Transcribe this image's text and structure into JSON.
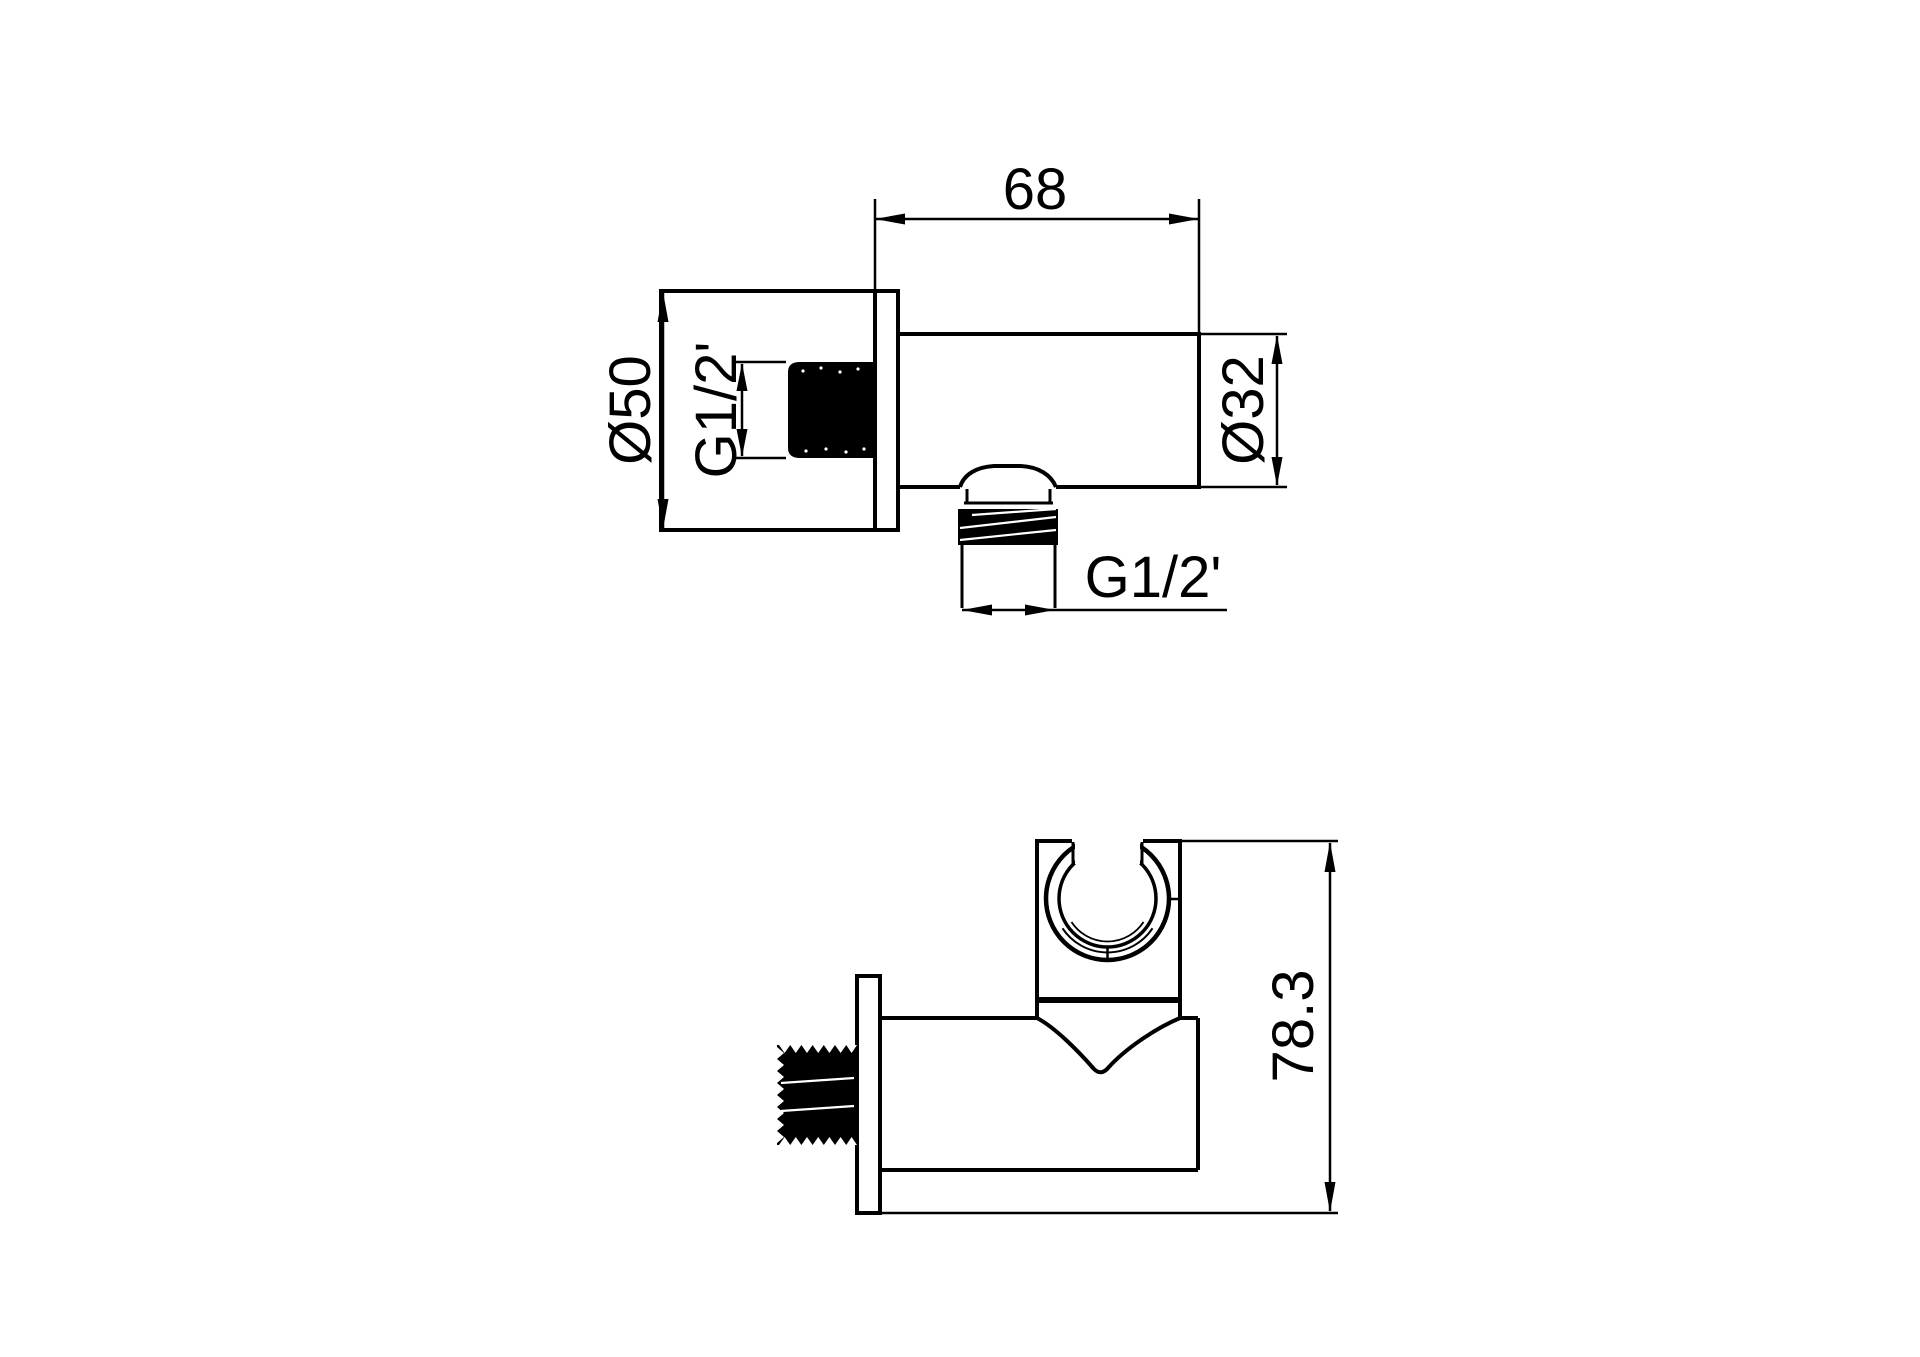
{
  "canvas": {
    "background": "#ffffff",
    "line_color": "#000000"
  },
  "side_view": {
    "dim_body_length": "68",
    "dim_flange_diameter": "Ø50",
    "dim_wall_thread": "G1/2'",
    "dim_body_diameter": "Ø32",
    "dim_outlet_thread": "G1/2'"
  },
  "front_view": {
    "dim_overall_height": "78.3"
  }
}
